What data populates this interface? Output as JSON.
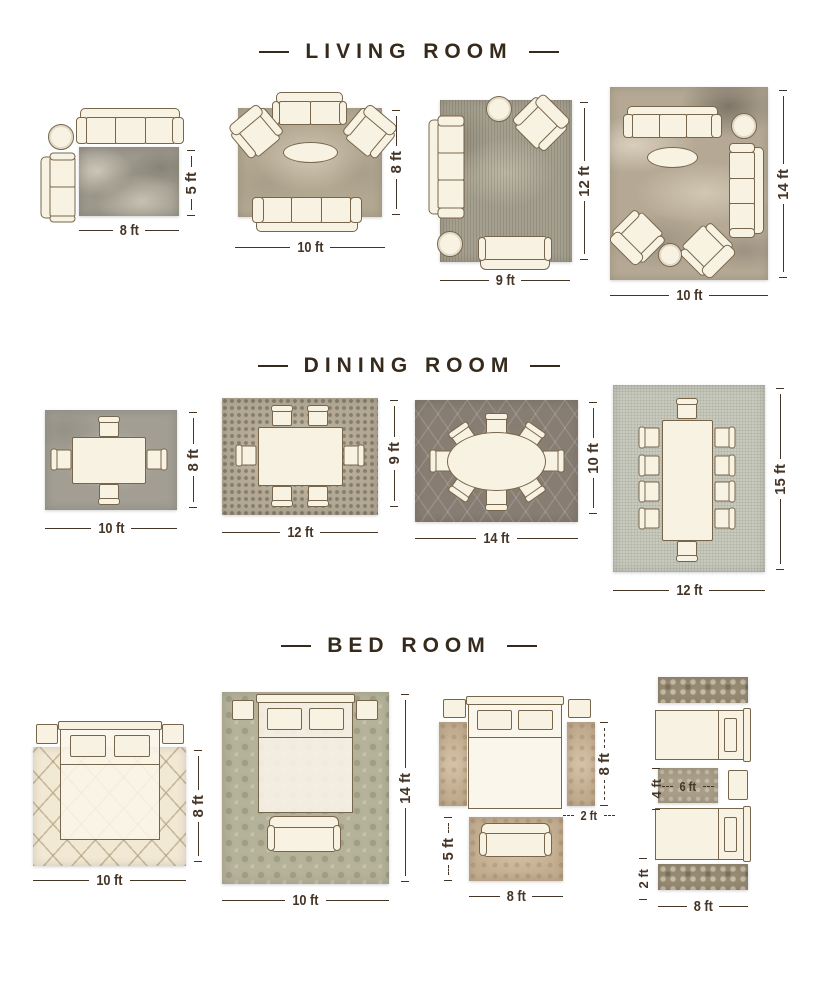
{
  "palette": {
    "background": "#ffffff",
    "title_color": "#362a1c",
    "dimension_color": "#453527",
    "furniture_fill": "#f8f2e2",
    "furniture_outline": "#77664c",
    "rug_base_colors": {
      "living": [
        "#9c988b",
        "#b2a791",
        "#a59f8f",
        "#b5a995"
      ],
      "dining": [
        "#a29e94",
        "#b2a894",
        "#877d72",
        "#c8cabe"
      ],
      "bedroom": [
        "#f2e9d4",
        "#b5b29a",
        "#c3ad90",
        "#968a72"
      ]
    }
  },
  "sections": [
    {
      "id": "living-room",
      "title": "LIVING ROOM",
      "layouts": [
        {
          "id": "living-8x5",
          "width_label": "8 ft",
          "height_label": "5 ft"
        },
        {
          "id": "living-10x8",
          "width_label": "10 ft",
          "height_label": "8 ft"
        },
        {
          "id": "living-9x12",
          "width_label": "9 ft",
          "height_label": "12 ft"
        },
        {
          "id": "living-10x14",
          "width_label": "10 ft",
          "height_label": "14 ft"
        }
      ]
    },
    {
      "id": "dining-room",
      "title": "DINING ROOM",
      "layouts": [
        {
          "id": "dining-10x8",
          "width_label": "10 ft",
          "height_label": "8 ft"
        },
        {
          "id": "dining-12x9",
          "width_label": "12 ft",
          "height_label": "9 ft"
        },
        {
          "id": "dining-14x10",
          "width_label": "14 ft",
          "height_label": "10 ft"
        },
        {
          "id": "dining-12x15",
          "width_label": "12 ft",
          "height_label": "15 ft"
        }
      ]
    },
    {
      "id": "bed-room",
      "title": "BED ROOM",
      "layouts": [
        {
          "id": "bed-10x8",
          "width_label": "10 ft",
          "height_label": "8 ft"
        },
        {
          "id": "bed-10x14",
          "width_label": "10 ft",
          "height_label": "14 ft"
        },
        {
          "id": "bed-runners-8x5",
          "runner_length_label": "8 ft",
          "runner_width_label": "2 ft",
          "rug_height_label": "5 ft",
          "rug_width_label": "8 ft"
        },
        {
          "id": "bed-twin-6x4",
          "rug_height_label": "4 ft",
          "rug_width_label": "6 ft",
          "runner_width_label": "2 ft",
          "runner_length_label": "8 ft"
        }
      ]
    }
  ]
}
